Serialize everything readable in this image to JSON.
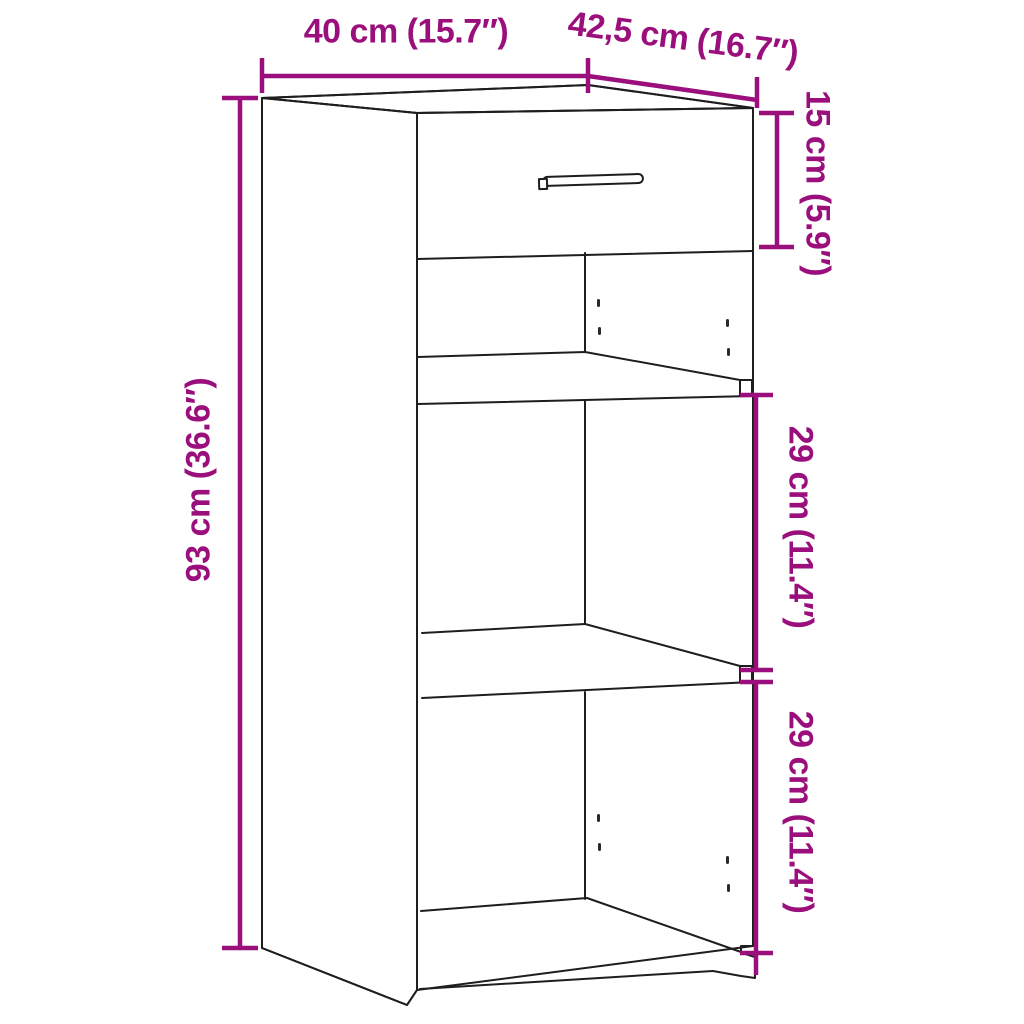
{
  "diagram": {
    "kind": "furniture-dimension-diagram",
    "subject": "cabinet with one drawer and two open shelf compartments"
  },
  "dimensions": {
    "width": {
      "label": "40 cm (15.7″)"
    },
    "depth": {
      "label": "42,5 cm (16.7″)"
    },
    "drawer_height": {
      "label": "15 cm (5.9″)"
    },
    "total_height": {
      "label": "93 cm (36.6″)"
    },
    "upper_shelf": {
      "label": "29 cm (11.4″)"
    },
    "lower_shelf": {
      "label": "29 cm (11.4″)"
    }
  },
  "colors": {
    "dimension_accent": "#9B0F7D",
    "line": "#1E1E1E",
    "background": "#FFFFFF"
  }
}
